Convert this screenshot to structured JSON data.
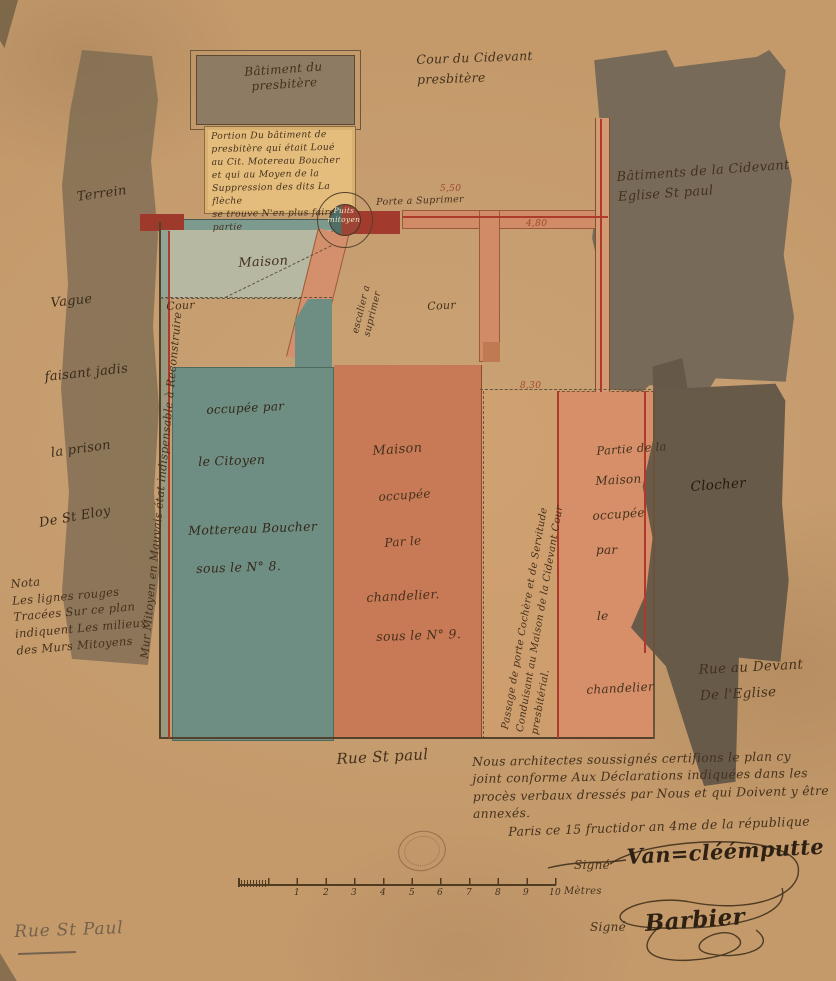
{
  "colors": {
    "paper": "#c49a6b",
    "ink": "#44311d",
    "red_line": "#ae3a2c",
    "teal_parcel": "#6f8e83",
    "orange_parcel": "#c87955",
    "right_parcel_orange": "#d68f69",
    "dark_wash": "#746757",
    "note_box": "#e4bd7d"
  },
  "plan": {
    "batiment_presbitere": "Bâtiment du\npresbitère",
    "portion_note": "Portion Du bâtiment de\npresbitère qui était Loué\nau Cit. Motereau Boucher\net qui au Moyen de la\nSuppression des dits La flèche\nse trouve N'en plus faire partie",
    "cour_cidevant": "Cour du Cidevant\npresbitère",
    "eglise": "Bâtiments de la Cidevant\nEglise St paul",
    "porte": "Porte a Suprimer",
    "puits": "Puits\nmitoyen",
    "escalier": "escalier a\nsuprimer",
    "left_words": [
      "Terrein",
      "Vague",
      "faisant jadis",
      "la prison",
      "De St Eloy"
    ],
    "mur_note": "Mur Mitoyen en Mauvais état   indispensable à Reconstruire",
    "nota": "Nota\nLes lignes rouges\nTracées Sur ce plan\nindiquent Les milieux\ndes Murs Mitoyens",
    "maison": "Maison",
    "cour_left": "Cour",
    "cour_center": "Cour",
    "green_parcel": [
      "occupée par",
      "le Citoyen",
      "Mottereau Boucher",
      "sous le N° 8."
    ],
    "orange_parcel": [
      "Maison",
      "occupée",
      "Par le",
      "chandelier.",
      "sous le N° 9."
    ],
    "passage_note": "Passage de porte Cochère et de Servitude\nConduisant au Maison de la Cidevant Cour\npresbitérial.",
    "right_parcel": [
      "Partie de la",
      "Maison",
      "occupée",
      "par",
      "le",
      "chandelier"
    ],
    "clocher": "Clocher",
    "rue_devant": "Rue au Devant\nDe l'Eglise",
    "dim_5_50": "5,50",
    "dim_4_80": "4,80",
    "dim_8_30": "8,30",
    "rue_st_paul": "Rue St paul"
  },
  "footer": {
    "certification": "Nous architectes soussignés certifions le plan cy\njoint conforme Aux Déclarations indiquées dans les\nprocès verbaux dressés par Nous et qui Doivent y être\nannexés.",
    "paris_line": "Paris ce 15 fructidor an 4me de la république",
    "signe": "Signé",
    "signature1": "Van=cléémputte",
    "signature2": "Barbier",
    "scale_numbers": [
      "1",
      "2",
      "3",
      "4",
      "5",
      "6",
      "7",
      "8",
      "9",
      "10"
    ],
    "scale_unit": "Mètres",
    "pencil_note": "Rue St Paul"
  }
}
